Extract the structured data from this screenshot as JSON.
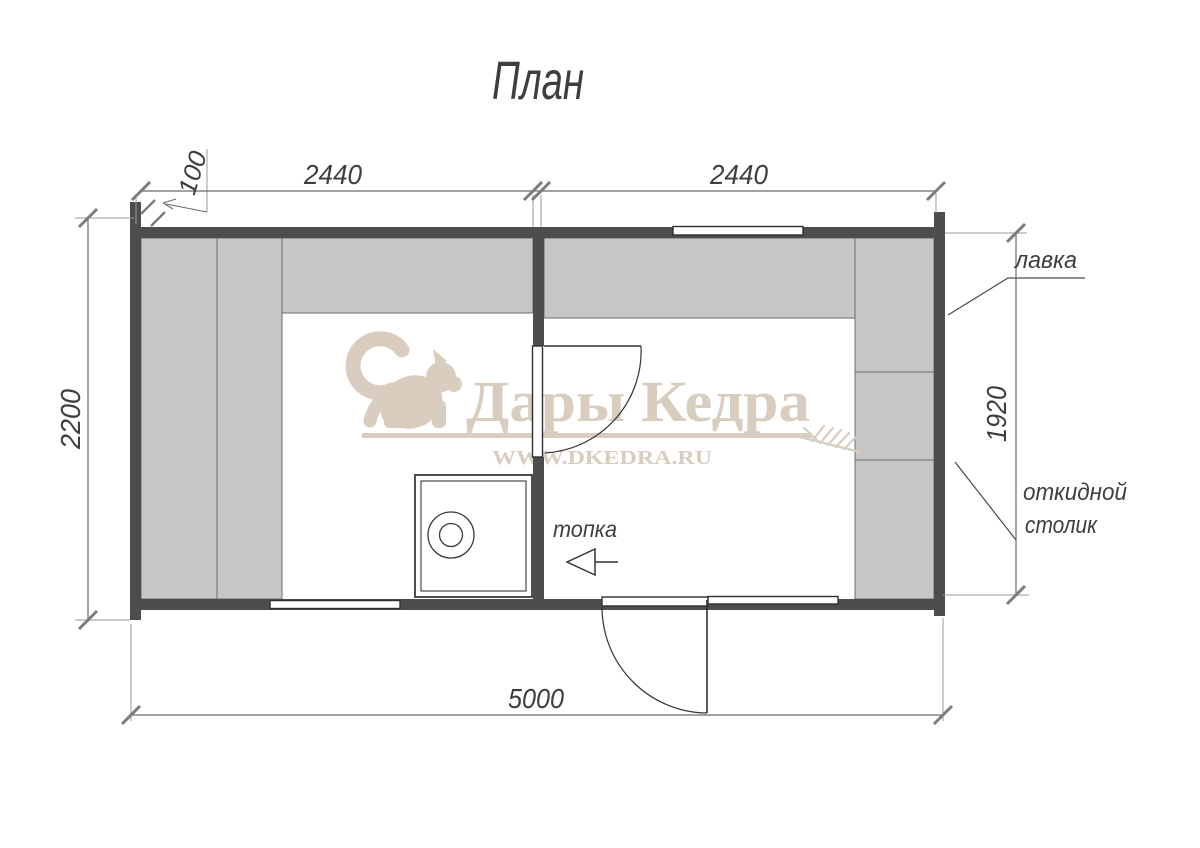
{
  "title": "План",
  "dimensions": {
    "wall_thickness": "100",
    "top_left_span": "2440",
    "top_right_span": "2440",
    "left_span": "2200",
    "right_span": "1920",
    "bottom_span": "5000"
  },
  "annotations": {
    "bench_label": "лавка",
    "folding_table_label": [
      "откидной",
      "столик"
    ],
    "firebox_label": "топка"
  },
  "watermark": {
    "brand": "Дары Кедра",
    "url": "WWW.DKEDRA.RU",
    "color": "#d8cdbf"
  },
  "colors": {
    "wall": "#4d4d4d",
    "bench": "#c6c6c6",
    "bench_border": "#6e6e6e",
    "drawing_line": "#333333",
    "dimension_line": "#6a6a6a",
    "text": "#3e3e3e",
    "watermark": "#d8cdbf"
  }
}
